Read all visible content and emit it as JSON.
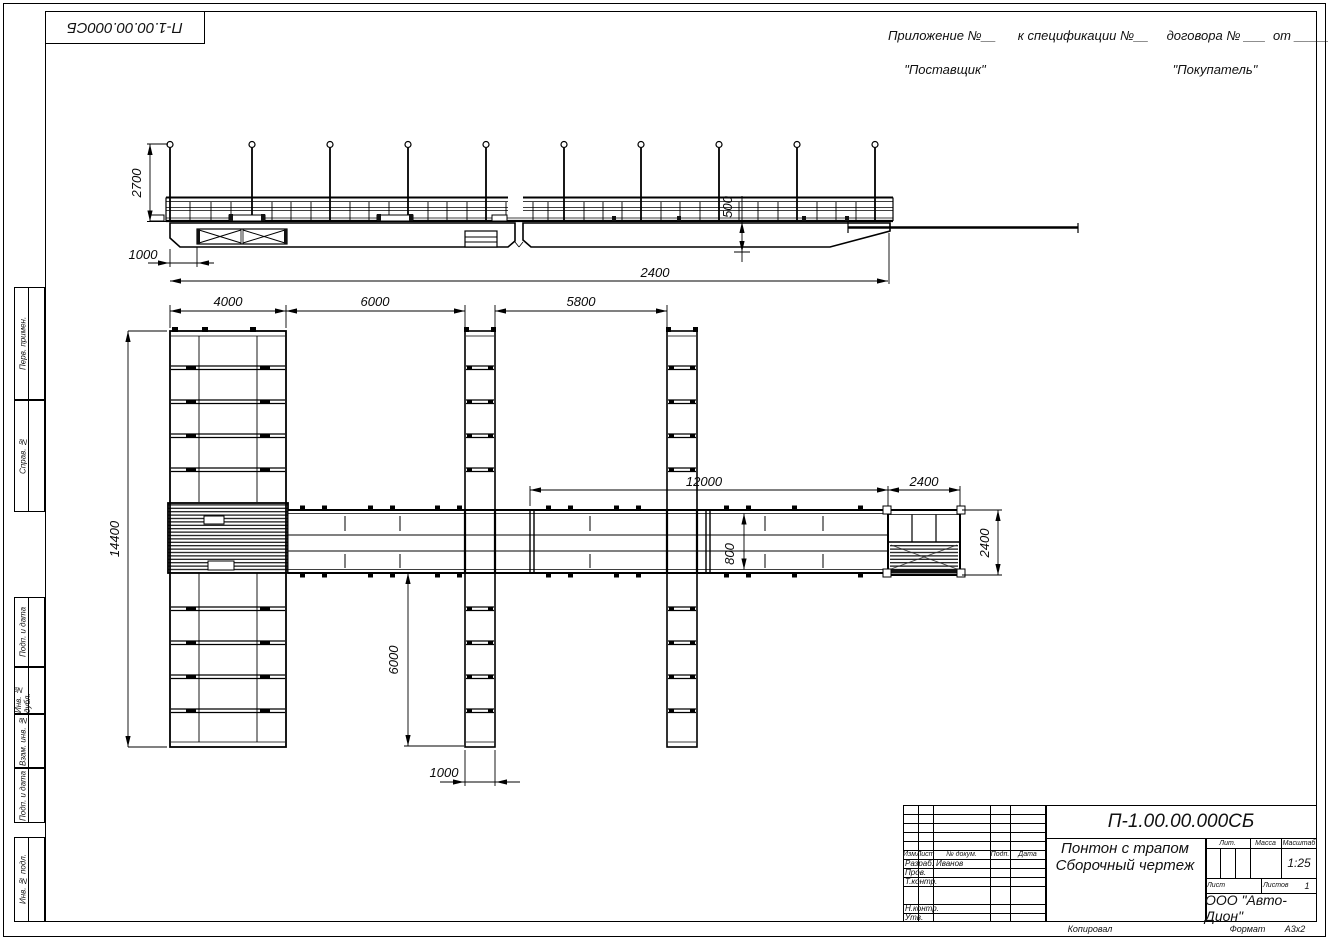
{
  "stamp_box": {
    "doc_number": "П-1.00.00.000СБ"
  },
  "header": {
    "line1": "Приложение №__      к спецификации №__     договора № ___  от __________",
    "supplier": "\"Поставщик\"",
    "buyer": "\"Покупатель\""
  },
  "margin_stamps": {
    "perv": "Перв. примен.",
    "sprav": "Справ. №",
    "podp1": "Подп. и дата",
    "inv_dubl": "Инв. № дубл.",
    "vzam": "Взам. инв. №",
    "podp2": "Подп. и дата",
    "inv_podl": "Инв. № подл."
  },
  "dims": {
    "d2700": "2700",
    "d1000_side": "1000",
    "d2400_side": "2400",
    "d500": "500",
    "d4000": "4000",
    "d6000_top": "6000",
    "d5800": "5800",
    "d12000": "12000",
    "d2400_trap_top": "2400",
    "d14400": "14400",
    "d800": "800",
    "d6000_bottom": "6000",
    "d1000_bottom": "1000",
    "d2400_trap_right": "2400"
  },
  "title_block": {
    "doc_number": "П-1.00.00.000СБ",
    "name_line1": "Понтон с трапом",
    "name_line2": "Сборочный чертеж",
    "col_izm": "Изм.",
    "col_list": "Лист",
    "col_doc": "№ докум.",
    "col_podp": "Подп.",
    "col_data": "Дата",
    "row_razrab": "Разраб.",
    "row_prov": "Пров.",
    "row_tkontr": "Т.контр.",
    "row_nkontr": "Н.контр.",
    "row_utv": "Утв.",
    "developer": "Иванов",
    "lit": "Лит.",
    "massa": "Масса",
    "masshtab": "Масштаб",
    "scale": "1:25",
    "list_label": "Лист",
    "listov_label": "Листов",
    "listov_value": "1",
    "company": "ООО \"Авто-Дион\""
  },
  "footer": {
    "copied": "Копировал",
    "format_label": "Формат",
    "format_value": "А3х2"
  }
}
